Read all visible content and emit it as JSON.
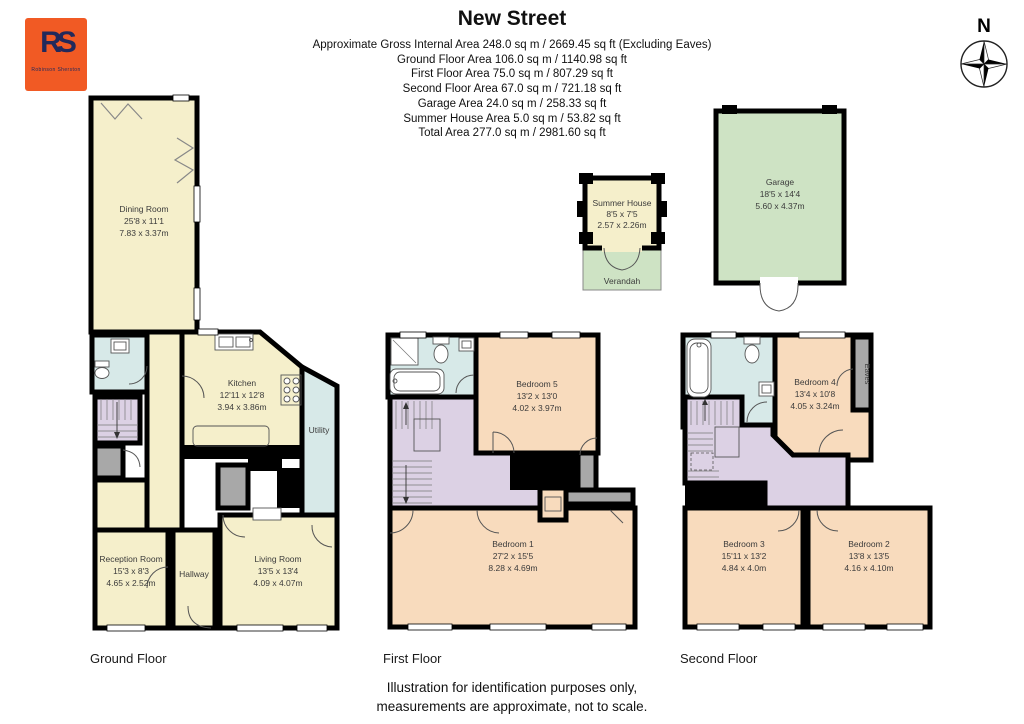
{
  "logo": {
    "initials": "RS",
    "company": "Robinson Sherston",
    "bg_color": "#F15A24",
    "fg_color": "#22295B"
  },
  "header": {
    "title": "New Street",
    "area_lines": [
      "Approximate Gross Internal Area 248.0 sq m / 2669.45 sq ft (Excluding Eaves)",
      "Ground Floor Area 106.0 sq m / 1140.98 sq ft",
      "First Floor Area 75.0 sq m / 807.29 sq ft",
      "Second Floor Area 67.0 sq m / 721.18 sq ft",
      "Garage Area 24.0 sq m / 258.33 sq ft",
      "Summer House Area 5.0 sq m / 53.82 sq ft",
      "Total Area 277.0 sq m / 2981.60 sq ft"
    ]
  },
  "compass": {
    "north_label": "N"
  },
  "floors": {
    "ground": {
      "label": "Ground Floor",
      "dining": {
        "name": "Dining Room",
        "ft": "25'8 x 11'1",
        "m": "7.83 x 3.37m"
      },
      "kitchen": {
        "name": "Kitchen",
        "ft": "12'11 x 12'8",
        "m": "3.94 x 3.86m"
      },
      "utility": {
        "name": "Utility"
      },
      "reception": {
        "name": "Reception Room",
        "ft": "15'3 x 8'3",
        "m": "4.65 x 2.52m"
      },
      "hallway": {
        "name": "Hallway"
      },
      "living": {
        "name": "Living Room",
        "ft": "13'5 x 13'4",
        "m": "4.09 x 4.07m"
      }
    },
    "first": {
      "label": "First Floor",
      "bedroom5": {
        "name": "Bedroom 5",
        "ft": "13'2 x 13'0",
        "m": "4.02 x 3.97m"
      },
      "bedroom1": {
        "name": "Bedroom 1",
        "ft": "27'2 x 15'5",
        "m": "8.28 x 4.69m"
      }
    },
    "second": {
      "label": "Second Floor",
      "bedroom4": {
        "name": "Bedroom 4",
        "ft": "13'4 x 10'8",
        "m": "4.05 x 3.24m"
      },
      "eaves": {
        "name": "Eaves"
      },
      "bedroom3": {
        "name": "Bedroom 3",
        "ft": "15'11 x 13'2",
        "m": "4.84 x 4.0m"
      },
      "bedroom2": {
        "name": "Bedroom 2",
        "ft": "13'8 x 13'5",
        "m": "4.16 x 4.10m"
      }
    },
    "garage": {
      "name": "Garage",
      "ft": "18'5 x 14'4",
      "m": "5.60 x 4.37m"
    },
    "summer_house": {
      "name": "Summer House",
      "ft": "8'5 x 7'5",
      "m": "2.57 x 2.26m",
      "verandah": "Verandah"
    }
  },
  "footer": {
    "line1": "Illustration for identification purposes only,",
    "line2": "measurements are approximate, not to scale."
  },
  "colors": {
    "room_cream": "#F5EFCB",
    "room_peach": "#F8DBBD",
    "room_lilac": "#DCD1E4",
    "room_blue": "#D7E9E8",
    "room_green": "#CEE3C4",
    "block_gray": "#A8A8A8",
    "wall": "#000000"
  }
}
